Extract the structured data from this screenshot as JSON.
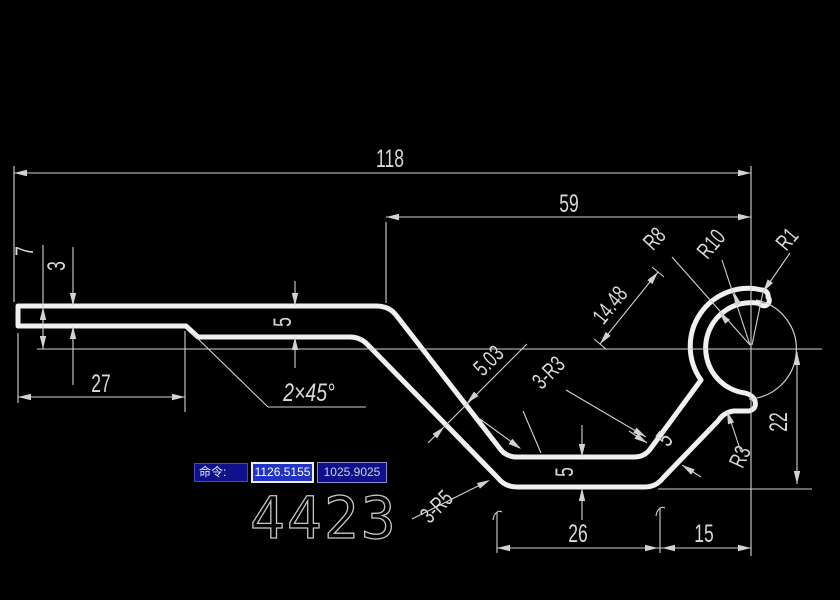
{
  "drawing": {
    "part_number": "4423",
    "labels": {
      "overall_length": "118",
      "upper_length": "59",
      "left_height": "7",
      "sheet_thickness": "3",
      "left_flat": "27",
      "chamfer": "2×45°",
      "web_thickness": "5",
      "diag_thickness": "5.03",
      "fillets_r3": "3-R3",
      "hook_offset": "14.48",
      "radius_r8": "R8",
      "radius_r10": "R10",
      "radius_r1": "R1",
      "hook_height": "22",
      "bottom_flat": "26",
      "right_flat": "15",
      "bottom_thickness": "5",
      "diag2_thickness": "5",
      "notch_radius": "R3",
      "fillets_r5": "3-R5"
    }
  },
  "command_bar": {
    "prompt": "命令:",
    "coord_x": "1126.5155",
    "coord_y": "1025.9025"
  },
  "colors": {
    "background": "#000000",
    "profile_line": "#f0f0f0",
    "dimension_line": "#d2d2d2",
    "dimension_text": "#d9d9d9",
    "command_box_blue": "#10108a",
    "command_box_border": "#4848c0",
    "selection_blue": "#2233c4",
    "selected_field_bg": "#ececec"
  }
}
